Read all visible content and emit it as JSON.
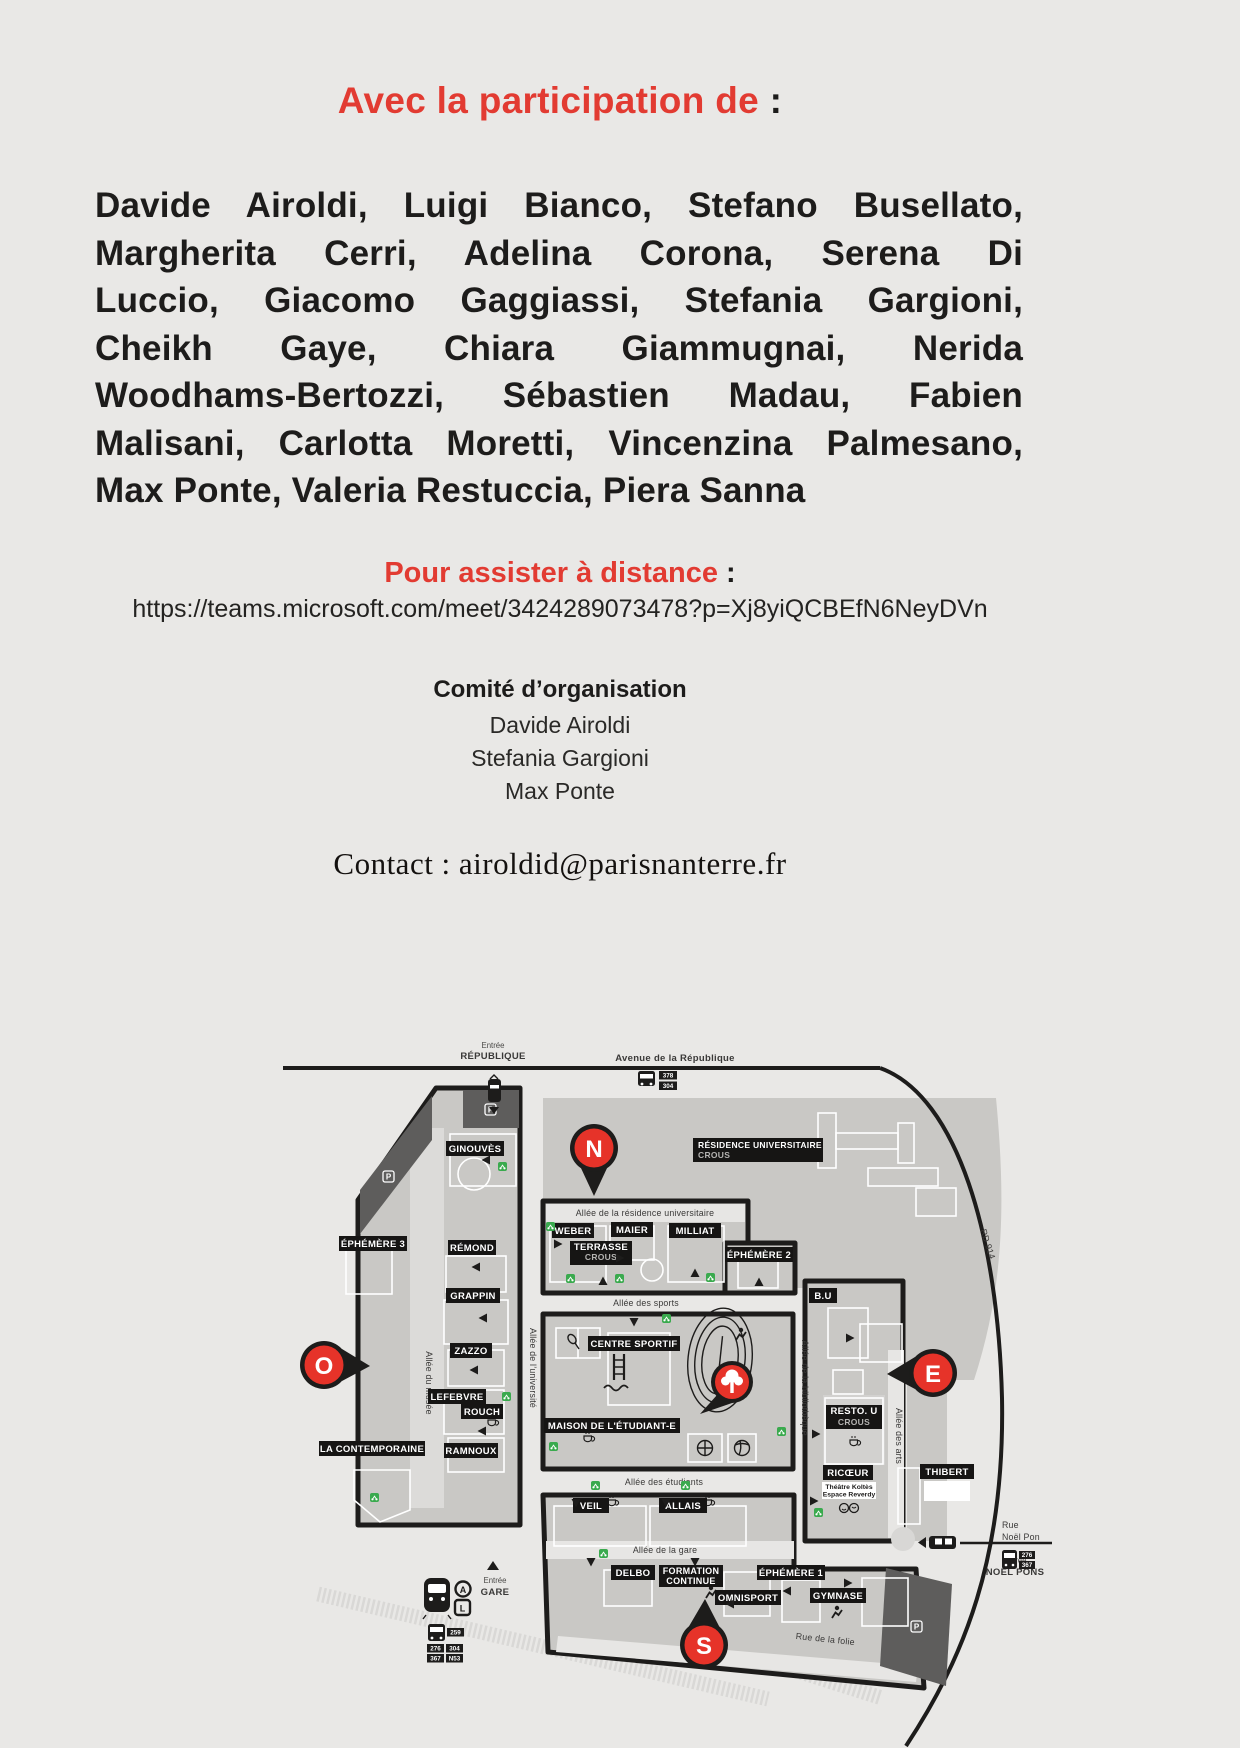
{
  "page": {
    "bg": "#e9e8e6",
    "accent_red": "#e23b32",
    "pin_red": "#e63329",
    "green": "#3aaa4e"
  },
  "header": {
    "title": "Avec la participation de",
    "colon": " :"
  },
  "participants": {
    "lines": [
      "Davide Airoldi, Luigi Bianco, Stefano Busellato,",
      "Margherita Cerri, Adelina Corona, Serena Di",
      "Luccio, Giacomo Gaggiassi, Stefania Gargioni,",
      "Cheikh Gaye, Chiara Giammugnai, Nerida",
      "Woodhams-Bertozzi, Sébastien Madau, Fabien",
      "Malisani, Carlotta Moretti, Vincenzina Palmesano,",
      "Max Ponte, Valeria Restuccia, Piera Sanna"
    ]
  },
  "remote": {
    "heading": "Pour assister à distance",
    "colon": " :",
    "url": "https://teams.microsoft.com/meet/3424289073478?p=Xj8yiQCBEfN6NeyDVn"
  },
  "committee": {
    "title": "Comité d’organisation",
    "members": [
      "Davide Airoldi",
      "Stefania Gargioni",
      "Max Ponte"
    ]
  },
  "contact": {
    "line": "Contact : airoldid@parisnanterre.fr"
  },
  "map": {
    "streets": {
      "entree_republique": [
        "Entrée",
        "RÉPUBLIQUE"
      ],
      "avenue": "Avenue de la République",
      "allee_residence": "Allée de la résidence universitaire",
      "allee_sports": "Allée des sports",
      "allee_etudiants": "Allée des étudiants",
      "allee_gare": "Allée de la gare",
      "rue_folie": "Rue de la folie",
      "rd914": "RD 914",
      "allee_musee": "Allée du musée",
      "allee_universite": "Allée de l’université",
      "allee_bibliotheque": "Allée de la bibliothèque",
      "allee_arts": "Allée des arts",
      "entree_gare": [
        "Entrée",
        "GARE"
      ],
      "entree_noel_pons": [
        "Entrée",
        "NOËL PONS"
      ],
      "rue_noel_pons": [
        "Rue",
        "Noël Pon"
      ]
    },
    "buildings": {
      "ginouves": "GINOUVÈS",
      "ephemere3": "ÉPHÉMÈRE 3",
      "remond": "RÉMOND",
      "grappin": "GRAPPIN",
      "zazzo": "ZAZZO",
      "lefebvre": "LEFEBVRE",
      "rouch": "ROUCH",
      "ramnoux": "RAMNOUX",
      "contemporaine": "LA CONTEMPORAINE",
      "weber": "WEBER",
      "maier": "MAIER",
      "milliat": "MILLIAT",
      "terrasse": "TERRASSE",
      "terrasse_sub": "CROUS",
      "ephemere2": "ÉPHÉMÈRE 2",
      "residence": "RÉSIDENCE UNIVERSITAIRE",
      "residence_sub": "CROUS",
      "bu": "B.U",
      "centre_sportif": "CENTRE SPORTIF",
      "mde": "MAISON DE L'ÉTUDIANT-E",
      "veil": "VEIL",
      "allais": "ALLAIS",
      "delbo": "DELBO",
      "formation": [
        "FORMATION",
        "CONTINUE"
      ],
      "omnisport": "OMNISPORT",
      "ephemere1": "ÉPHÉMÈRE 1",
      "gymnase": "GYMNASE",
      "restou": "RESTO. U",
      "restou_sub": "CROUS",
      "ricoeur": "RICŒUR",
      "ricoeur_sub": [
        "Théâtre Koltès",
        "Espace Reverdy"
      ],
      "thibert": "THIBERT"
    },
    "pins": {
      "north": "N",
      "west": "O",
      "east": "E",
      "south": "S"
    },
    "transit": {
      "bus_top": [
        "378",
        "304"
      ],
      "bus_gare": [
        "259",
        "276",
        "304",
        "367",
        "N53"
      ],
      "bus_pons": [
        "276",
        "367"
      ],
      "rer_a": "A",
      "ligne_l": "L",
      "parking": "P"
    }
  }
}
